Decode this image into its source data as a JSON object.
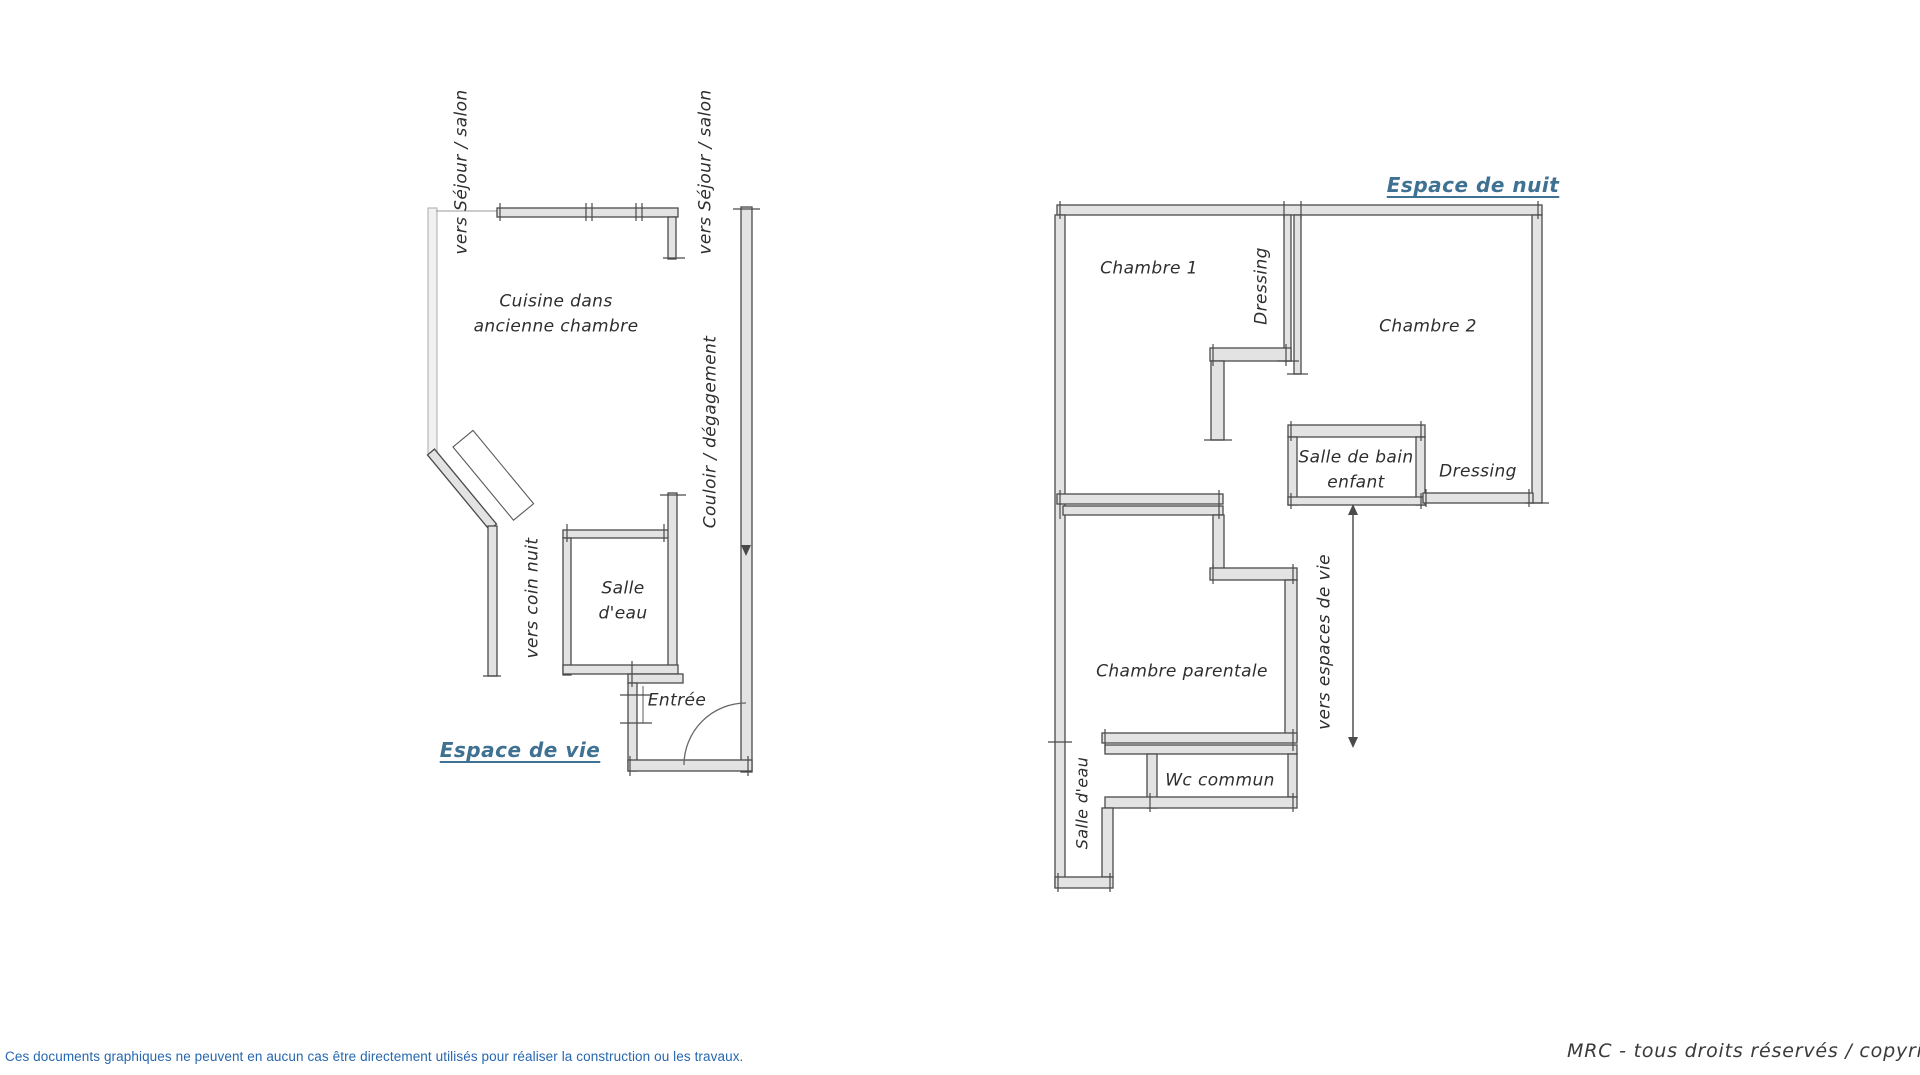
{
  "colors": {
    "wall_stroke": "#4a4a4a",
    "wall_fill": "#e3e3e3",
    "faded_wall_stroke": "#b8b8b8",
    "label_text": "#2e2e2e",
    "zone_title_blue": "#3f7192",
    "disclaimer_blue": "#2667b0"
  },
  "left_plan": {
    "zone_title": "Espace de vie",
    "labels": {
      "vers_sejour_salon_1": "vers Séjour / salon",
      "vers_sejour_salon_2": "vers Séjour / salon",
      "cuisine_line1": "Cuisine dans",
      "cuisine_line2": "ancienne chambre",
      "couloir": "Couloir / dégagement",
      "vers_coin_nuit": "vers coin nuit",
      "salle_eau_line1": "Salle",
      "salle_eau_line2": "d'eau",
      "entree": "Entrée"
    }
  },
  "right_plan": {
    "zone_title": "Espace de nuit",
    "labels": {
      "chambre_1": "Chambre 1",
      "dressing_1": "Dressing",
      "chambre_2": "Chambre 2",
      "salle_de_bain_enfant_line1": "Salle de bain",
      "salle_de_bain_enfant_line2": "enfant",
      "dressing_2": "Dressing",
      "chambre_parentale": "Chambre parentale",
      "vers_espaces_de_vie": "vers  espaces de vie",
      "salle_eau": "Salle d'eau",
      "wc_commun": "Wc commun"
    }
  },
  "footer": {
    "disclaimer": "Ces documents graphiques ne peuvent en aucun cas être directement utilisés pour réaliser la construction ou les travaux.",
    "copyright": "MRC - tous droits réservés / copyright°"
  }
}
